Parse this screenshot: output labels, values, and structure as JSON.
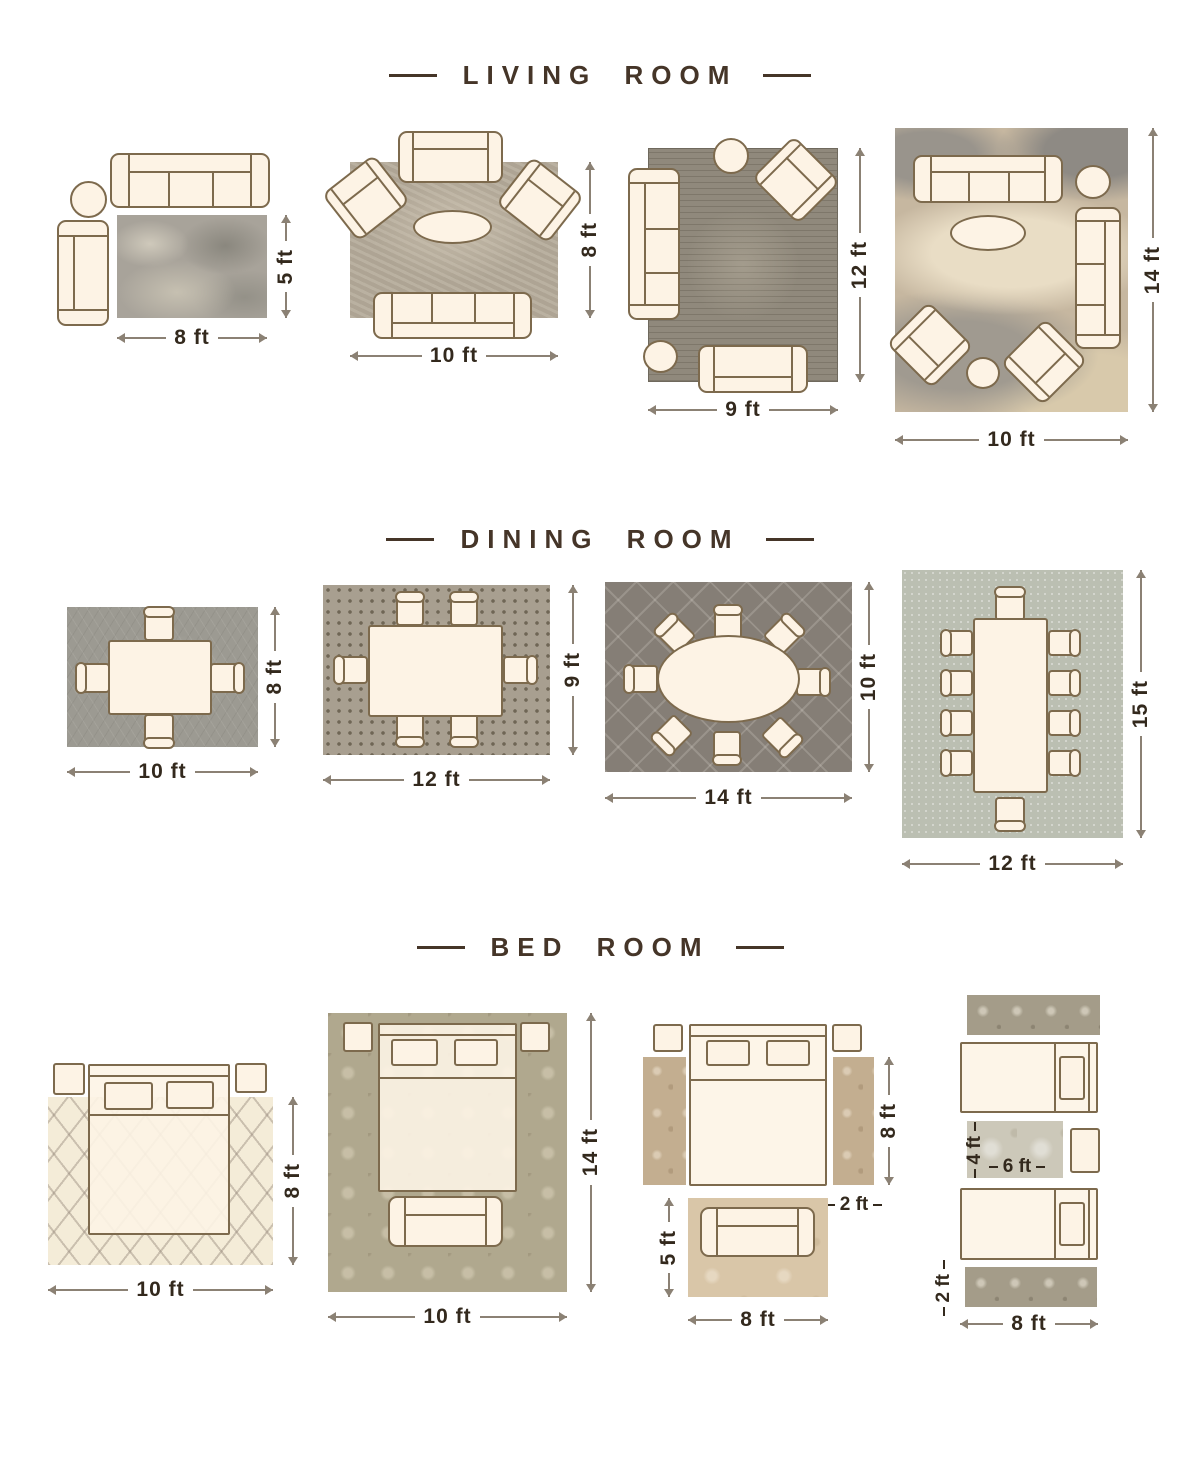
{
  "titles": {
    "living": "LIVING ROOM",
    "dining": "DINING ROOM",
    "bed": "BED ROOM"
  },
  "living": {
    "l1": {
      "w": "8 ft",
      "h": "5 ft"
    },
    "l2": {
      "w": "10 ft",
      "h": "8 ft"
    },
    "l3": {
      "w": "9 ft",
      "h": "12 ft"
    },
    "l4": {
      "w": "10 ft",
      "h": "14 ft"
    }
  },
  "dining": {
    "d1": {
      "w": "10 ft",
      "h": "8 ft"
    },
    "d2": {
      "w": "12 ft",
      "h": "9 ft"
    },
    "d3": {
      "w": "14 ft",
      "h": "10 ft"
    },
    "d4": {
      "w": "12 ft",
      "h": "15 ft"
    }
  },
  "bedroom": {
    "b1": {
      "w": "10 ft",
      "h": "8 ft"
    },
    "b2": {
      "w": "10 ft",
      "h": "14 ft"
    },
    "b3": {
      "side_h": "8 ft",
      "side_w": "2 ft",
      "foot_h": "5 ft",
      "foot_w": "8 ft"
    },
    "b4": {
      "center_h": "4 ft",
      "center_w": "6 ft",
      "runner_h": "2 ft",
      "runner_w": "8 ft"
    }
  },
  "icons": [
    "sofa",
    "loveseat",
    "armchair",
    "round-side-table",
    "oval-coffee-table",
    "dining-table",
    "dining-chair",
    "bed",
    "nightstand",
    "bench",
    "rug",
    "runner-rug",
    "dimension-arrow"
  ],
  "colors": {
    "background": "#ffffff",
    "title_text": "#453528",
    "dimension_text": "#33291d",
    "furniture_fill": "#fdf3e5",
    "furniture_outline": "#7d6a4d",
    "arrow_line": "#8b8174"
  }
}
